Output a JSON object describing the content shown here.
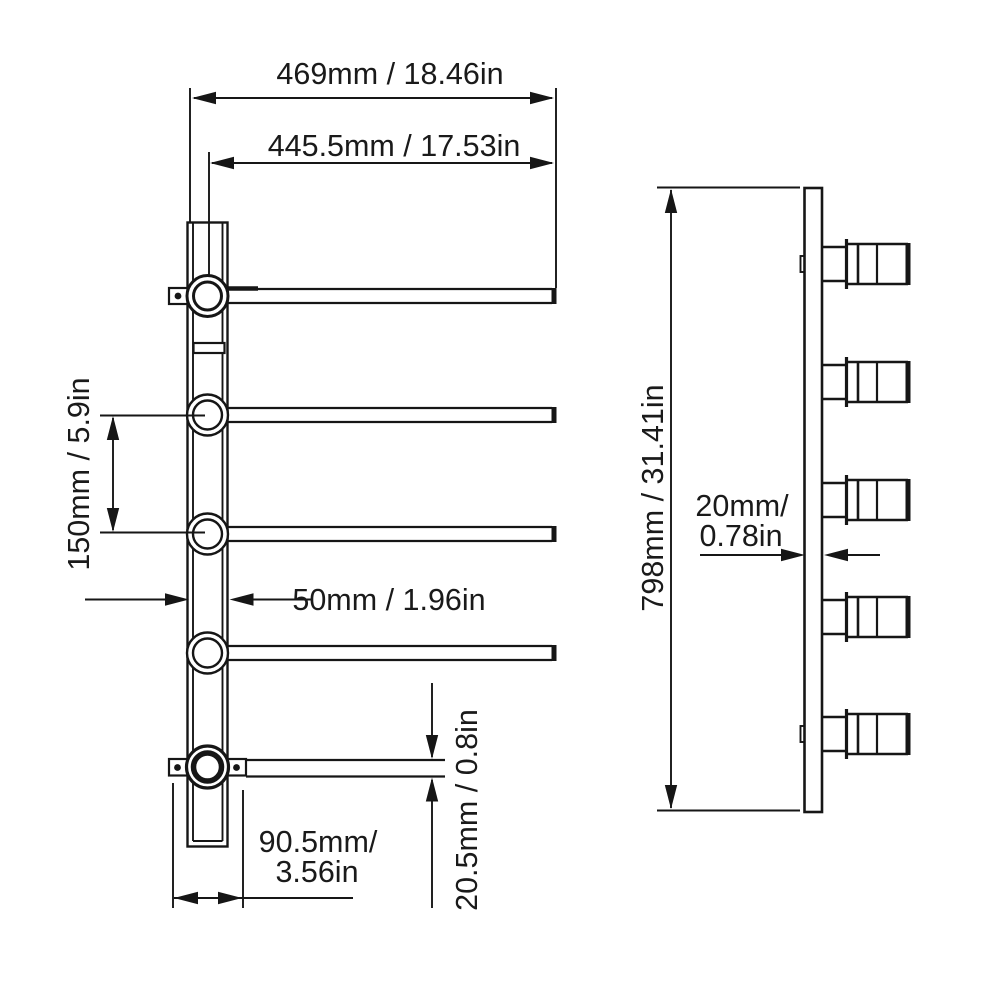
{
  "figure": {
    "description": "Technical dimension drawing of a five-bar wall-mounted towel rack: front view on the left, side profile view on the right",
    "background_color": "#ffffff",
    "line_color": "#161616"
  },
  "front_view": {
    "labels": {
      "overall_width": "469mm / 18.46in",
      "bar_length": "445.5mm / 17.53in",
      "bar_spacing": "150mm / 5.9in",
      "post_width": "50mm / 1.96in",
      "base_offset_line1": "90.5mm/",
      "base_offset_line2": "3.56in",
      "bar_thickness": "20.5mm / 0.8in"
    }
  },
  "side_view": {
    "labels": {
      "overall_height": "798mm / 31.41in",
      "plate_depth_line1": "20mm/",
      "plate_depth_line2": "0.78in"
    }
  }
}
